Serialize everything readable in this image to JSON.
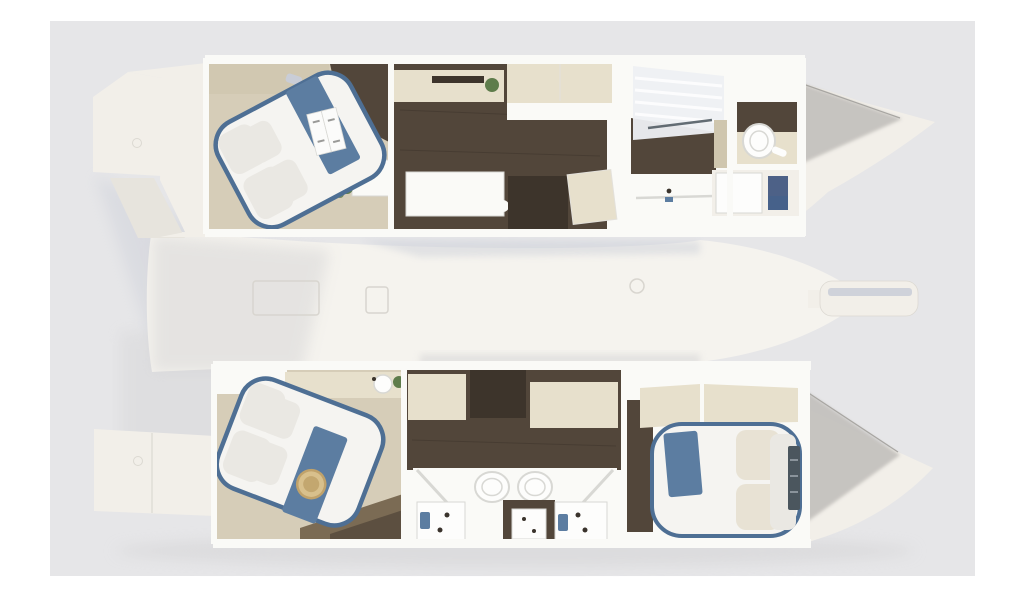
{
  "colors": {
    "page_bg": "#ffffff",
    "backdrop": "#e6e6e8",
    "hull": "#f2efe9",
    "hull_shade": "#e7e4dd",
    "hull_edge": "#dcd9d2",
    "deck": "#f5f3ee",
    "deck_shadow": "#c9cdd7",
    "soft_shadow": "#d2d1d3",
    "bow_shadow": "#c2c0bc",
    "bow_edge": "#a8a6a2",
    "wall": "#fafaf7",
    "wall_edge": "#e3e1db",
    "floor_wood": "#52463a",
    "floor_wood_dark": "#3d342b",
    "floor_beige": "#d6cdb8",
    "cabinet_cream": "#e7e0cc",
    "cabinet_cream_dark": "#cfc6ae",
    "wood_mid": "#7b6b54",
    "bed_white": "#f5f4f1",
    "pillow": "#eae8e3",
    "pillow_beige": "#e8e2d4",
    "trim_navy": "#4e6f94",
    "fabric_blue": "#5c7da1",
    "fabric_blue_dark": "#46618a",
    "storage_blue": "#4d6187",
    "fixture_white": "#fdfdfc",
    "fixture_edge": "#d8d8d4",
    "hardware_dark": "#3a332c",
    "plant_green": "#5e7c4b",
    "hat_tan": "#d8c08c",
    "hat_tan_dark": "#c0a26a",
    "glass_tint": "#eef0f3",
    "glass_stripe": "#ffffff",
    "steps_dark": "#4b565e",
    "steps_rung": "#8a939b",
    "magazine_page": "#fbfbfa",
    "magazine_text": "#9a9a98",
    "hatch_line": "#d8d5cf"
  }
}
